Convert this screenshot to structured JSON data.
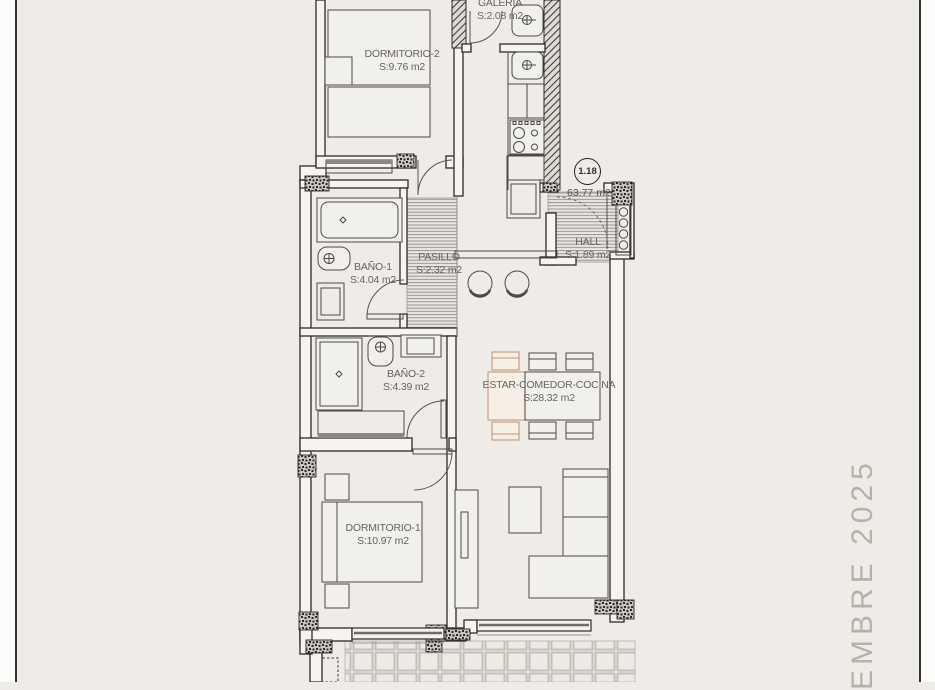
{
  "page": {
    "background": "#efece7",
    "border_color": "#32322f",
    "side_note": "EMBRE 2025"
  },
  "plan": {
    "unit_badge": "1.18",
    "total_area": "63.77 m2",
    "accent_color": "#c49a7c",
    "rooms": {
      "dormitorio2": {
        "name": "DORMITORIO-2",
        "area": "S:9.76 m2"
      },
      "galeria": {
        "name": "GALERIA",
        "area": "S:2.08 m2"
      },
      "bano1": {
        "name": "BAÑO-1",
        "area": "S:4.04 m2"
      },
      "pasillo": {
        "name": "PASILLO",
        "area": "S:2.32 m2"
      },
      "hall": {
        "name": "HALL",
        "area": "S:1.89 m2"
      },
      "bano2": {
        "name": "BAÑO-2",
        "area": "S:4.39 m2"
      },
      "estar": {
        "name": "ESTAR-COMEDOR-COCINA",
        "area": "S:28.32 m2"
      },
      "dormitorio1": {
        "name": "DORMITORIO-1",
        "area": "S:10.97 m2"
      }
    }
  }
}
